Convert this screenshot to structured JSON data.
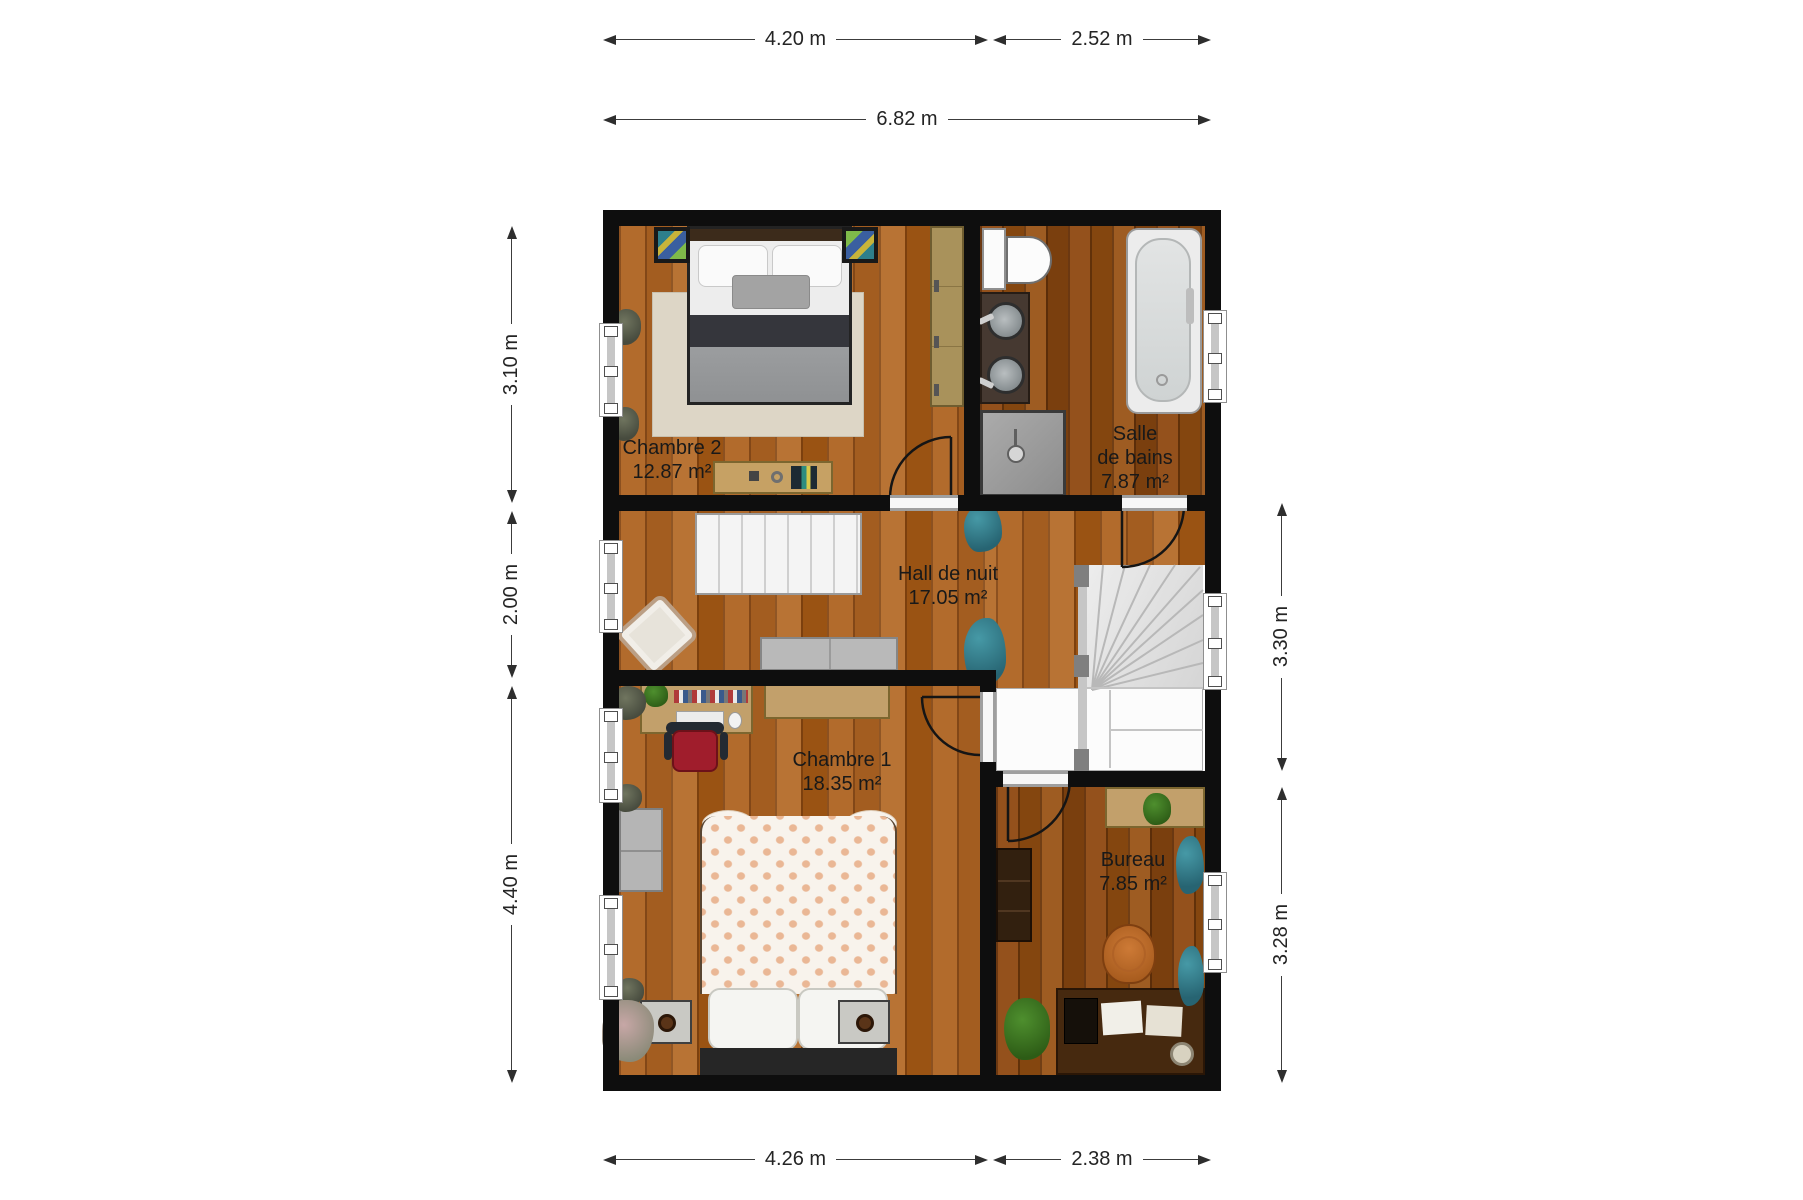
{
  "plan": {
    "rooms": [
      {
        "name": "Chambre 2",
        "area": "12.87 m²",
        "lines": [
          "Chambre 2",
          "12.87 m²"
        ]
      },
      {
        "name": "Salle de bains",
        "area": "7.87 m²",
        "lines": [
          "Salle",
          "de bains",
          "7.87 m²"
        ]
      },
      {
        "name": "Hall de nuit",
        "area": "17.05 m²",
        "lines": [
          "Hall de nuit",
          "17.05 m²"
        ]
      },
      {
        "name": "Chambre 1",
        "area": "18.35 m²",
        "lines": [
          "Chambre 1",
          "18.35 m²"
        ]
      },
      {
        "name": "Bureau",
        "area": "7.85 m²",
        "lines": [
          "Bureau",
          "7.85 m²"
        ]
      }
    ],
    "dimensions": {
      "top_left": "4.20 m",
      "top_right": "2.52 m",
      "top_total": "6.82 m",
      "left_upper": "3.10 m",
      "left_middle": "2.00 m",
      "left_lower": "4.40 m",
      "right_upper": "3.30 m",
      "right_lower": "3.28 m",
      "bottom_left": "4.26 m",
      "bottom_right": "2.38 m"
    },
    "colors": {
      "wall": "#0e0e0e",
      "wood_light": "#b26b2c",
      "wood_dark": "#94511c",
      "stair": "#e4e4e4",
      "accent_teal": "#38808f",
      "accent_red_chair": "#a01d2c",
      "accent_orange_chair": "#cd7a36"
    }
  }
}
